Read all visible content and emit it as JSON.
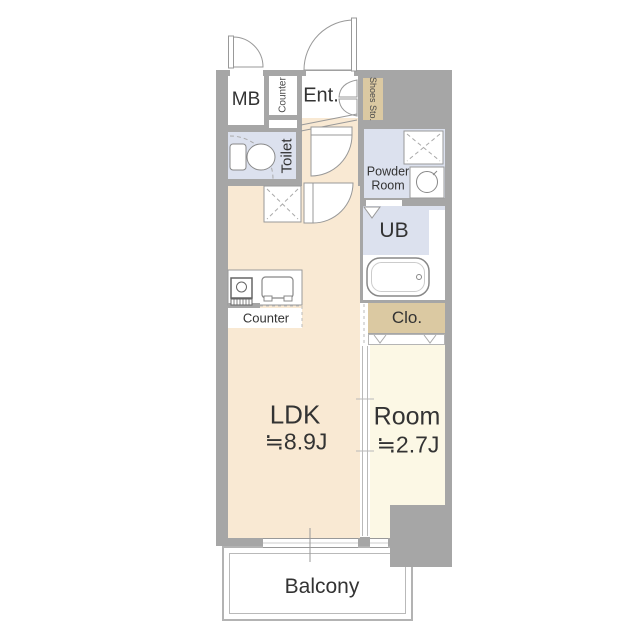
{
  "plan": {
    "type": "apartment-floor-plan",
    "rooms": {
      "meter_box": {
        "label": "MB"
      },
      "entry_counter": {
        "label": "Counter"
      },
      "entrance": {
        "label": "Ent."
      },
      "shoes_storage": {
        "label": "Shoes Sto."
      },
      "toilet": {
        "label": "Toilet"
      },
      "powder_room": {
        "label": "Powder Room"
      },
      "unit_bath": {
        "label": "UB"
      },
      "closet": {
        "label": "Clo."
      },
      "ldk": {
        "label": "LDK",
        "size": "≒8.9J"
      },
      "room": {
        "label": "Room",
        "size": "≒2.7J"
      },
      "kitchen_counter": {
        "label": "Counter"
      },
      "balcony": {
        "label": "Balcony"
      }
    },
    "colors": {
      "wall": "#a6a6a6",
      "ldk_floor": "#f9e9d3",
      "room_floor": "#fcf8e5",
      "wet_area_floor": "#dce1ee",
      "storage_fill": "#dbc9a2",
      "outline": "#999999",
      "text": "#333333"
    },
    "icons": [
      "door-swing-icon",
      "double-door-icon",
      "toilet-icon",
      "washing-machine-icon",
      "wash-basin-icon",
      "bathtub-icon",
      "stove-icon",
      "kitchen-sink-icon",
      "sliding-door-icon",
      "folding-door-icon",
      "sliding-window-icon"
    ]
  }
}
